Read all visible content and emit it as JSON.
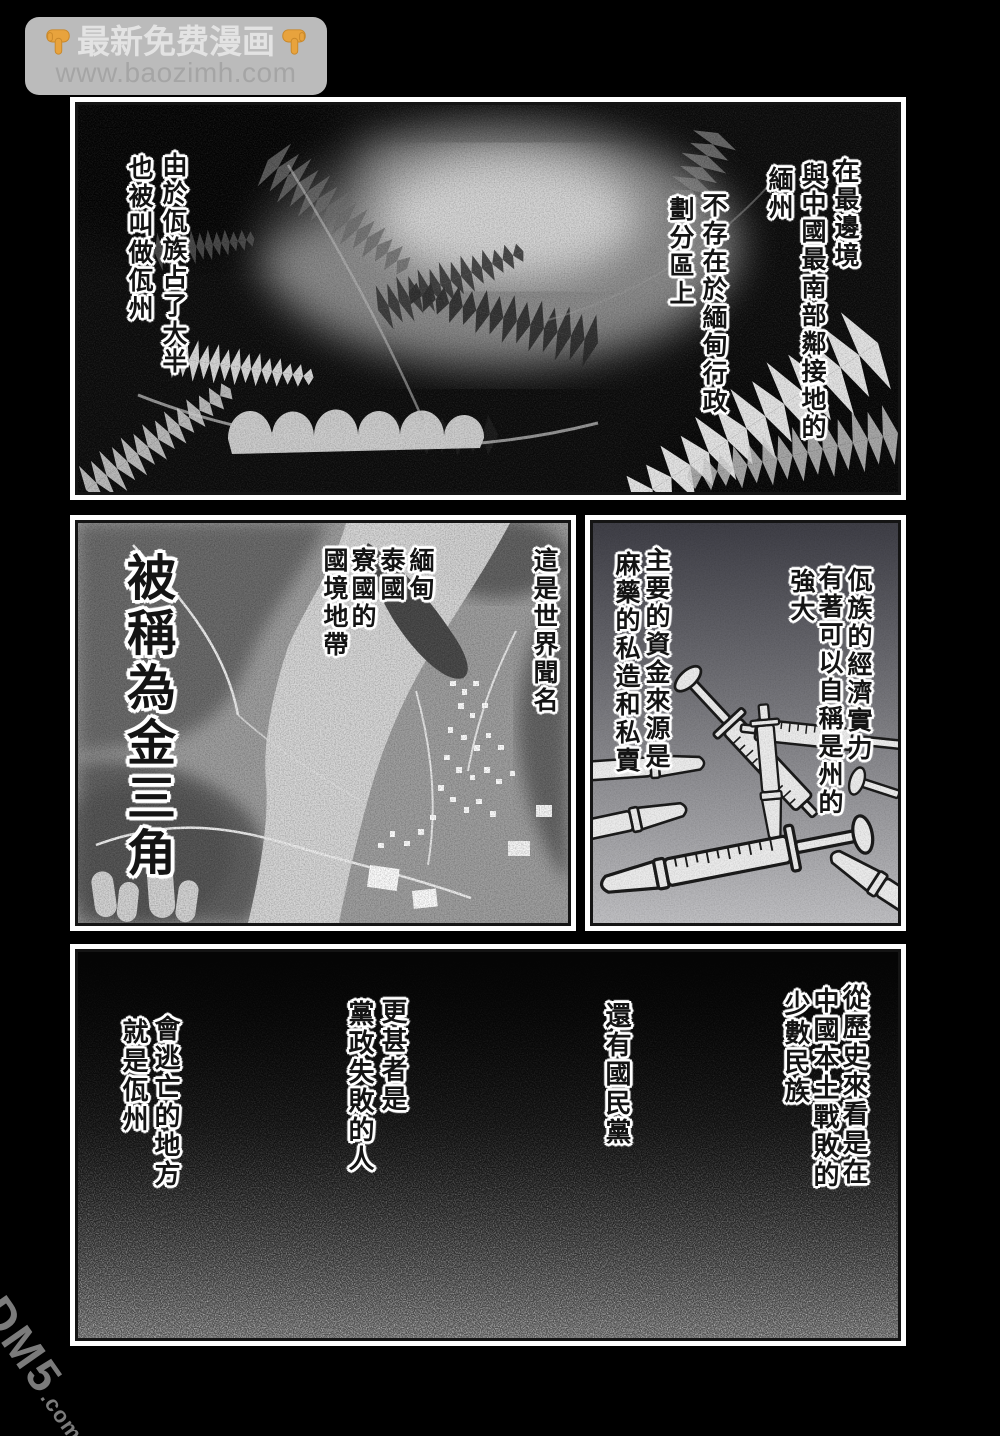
{
  "page": {
    "bg": "#000000",
    "width": 1000,
    "height": 1436
  },
  "watermark_top": {
    "line1": "最新免费漫画",
    "line2": "www.baozimh.com",
    "left_icon": "pointing-down-hand",
    "right_icon": "pointing-down-hand",
    "icon_color": "#E8A33D",
    "box_color": "#CBCBCB",
    "line1_color": "#E3E3E3",
    "line2_color": "#A5A5A5"
  },
  "panels": {
    "jungle": {
      "name": "jungle-establishing-shot",
      "right_columns": [
        "在最邊境",
        "與中國最南部鄰接地的",
        "緬州",
        "不存在於緬甸行政",
        "劃分區上"
      ],
      "left_columns": [
        "由於佤族占了大半",
        "也被叫做佤州"
      ]
    },
    "map": {
      "name": "golden-triangle-map",
      "right_columns": [
        "這是世界聞名",
        "緬甸",
        "泰國",
        "寮國的",
        "國境地帶"
      ],
      "title_large": "被稱為金三角"
    },
    "syringes": {
      "name": "syringes-still-life",
      "right_columns": [
        "佤族的經濟實力",
        "有著可以自稱是州的",
        "強大"
      ],
      "left_columns": [
        "主要的資金來源是",
        "麻藥的私造和私賣"
      ]
    },
    "dark": {
      "name": "narration-on-black",
      "group1": [
        "從歷史來看是在",
        "中國本土戰敗的",
        "少數民族"
      ],
      "group2": [
        "還有國民黨"
      ],
      "group3": [
        "更甚者是",
        "黨政失敗的人"
      ],
      "group4": [
        "會逃亡的地方",
        "就是佤州"
      ]
    }
  },
  "watermark_bottom": {
    "main": "DM5",
    "suffix": ".com",
    "color": "#8D8D8D"
  }
}
